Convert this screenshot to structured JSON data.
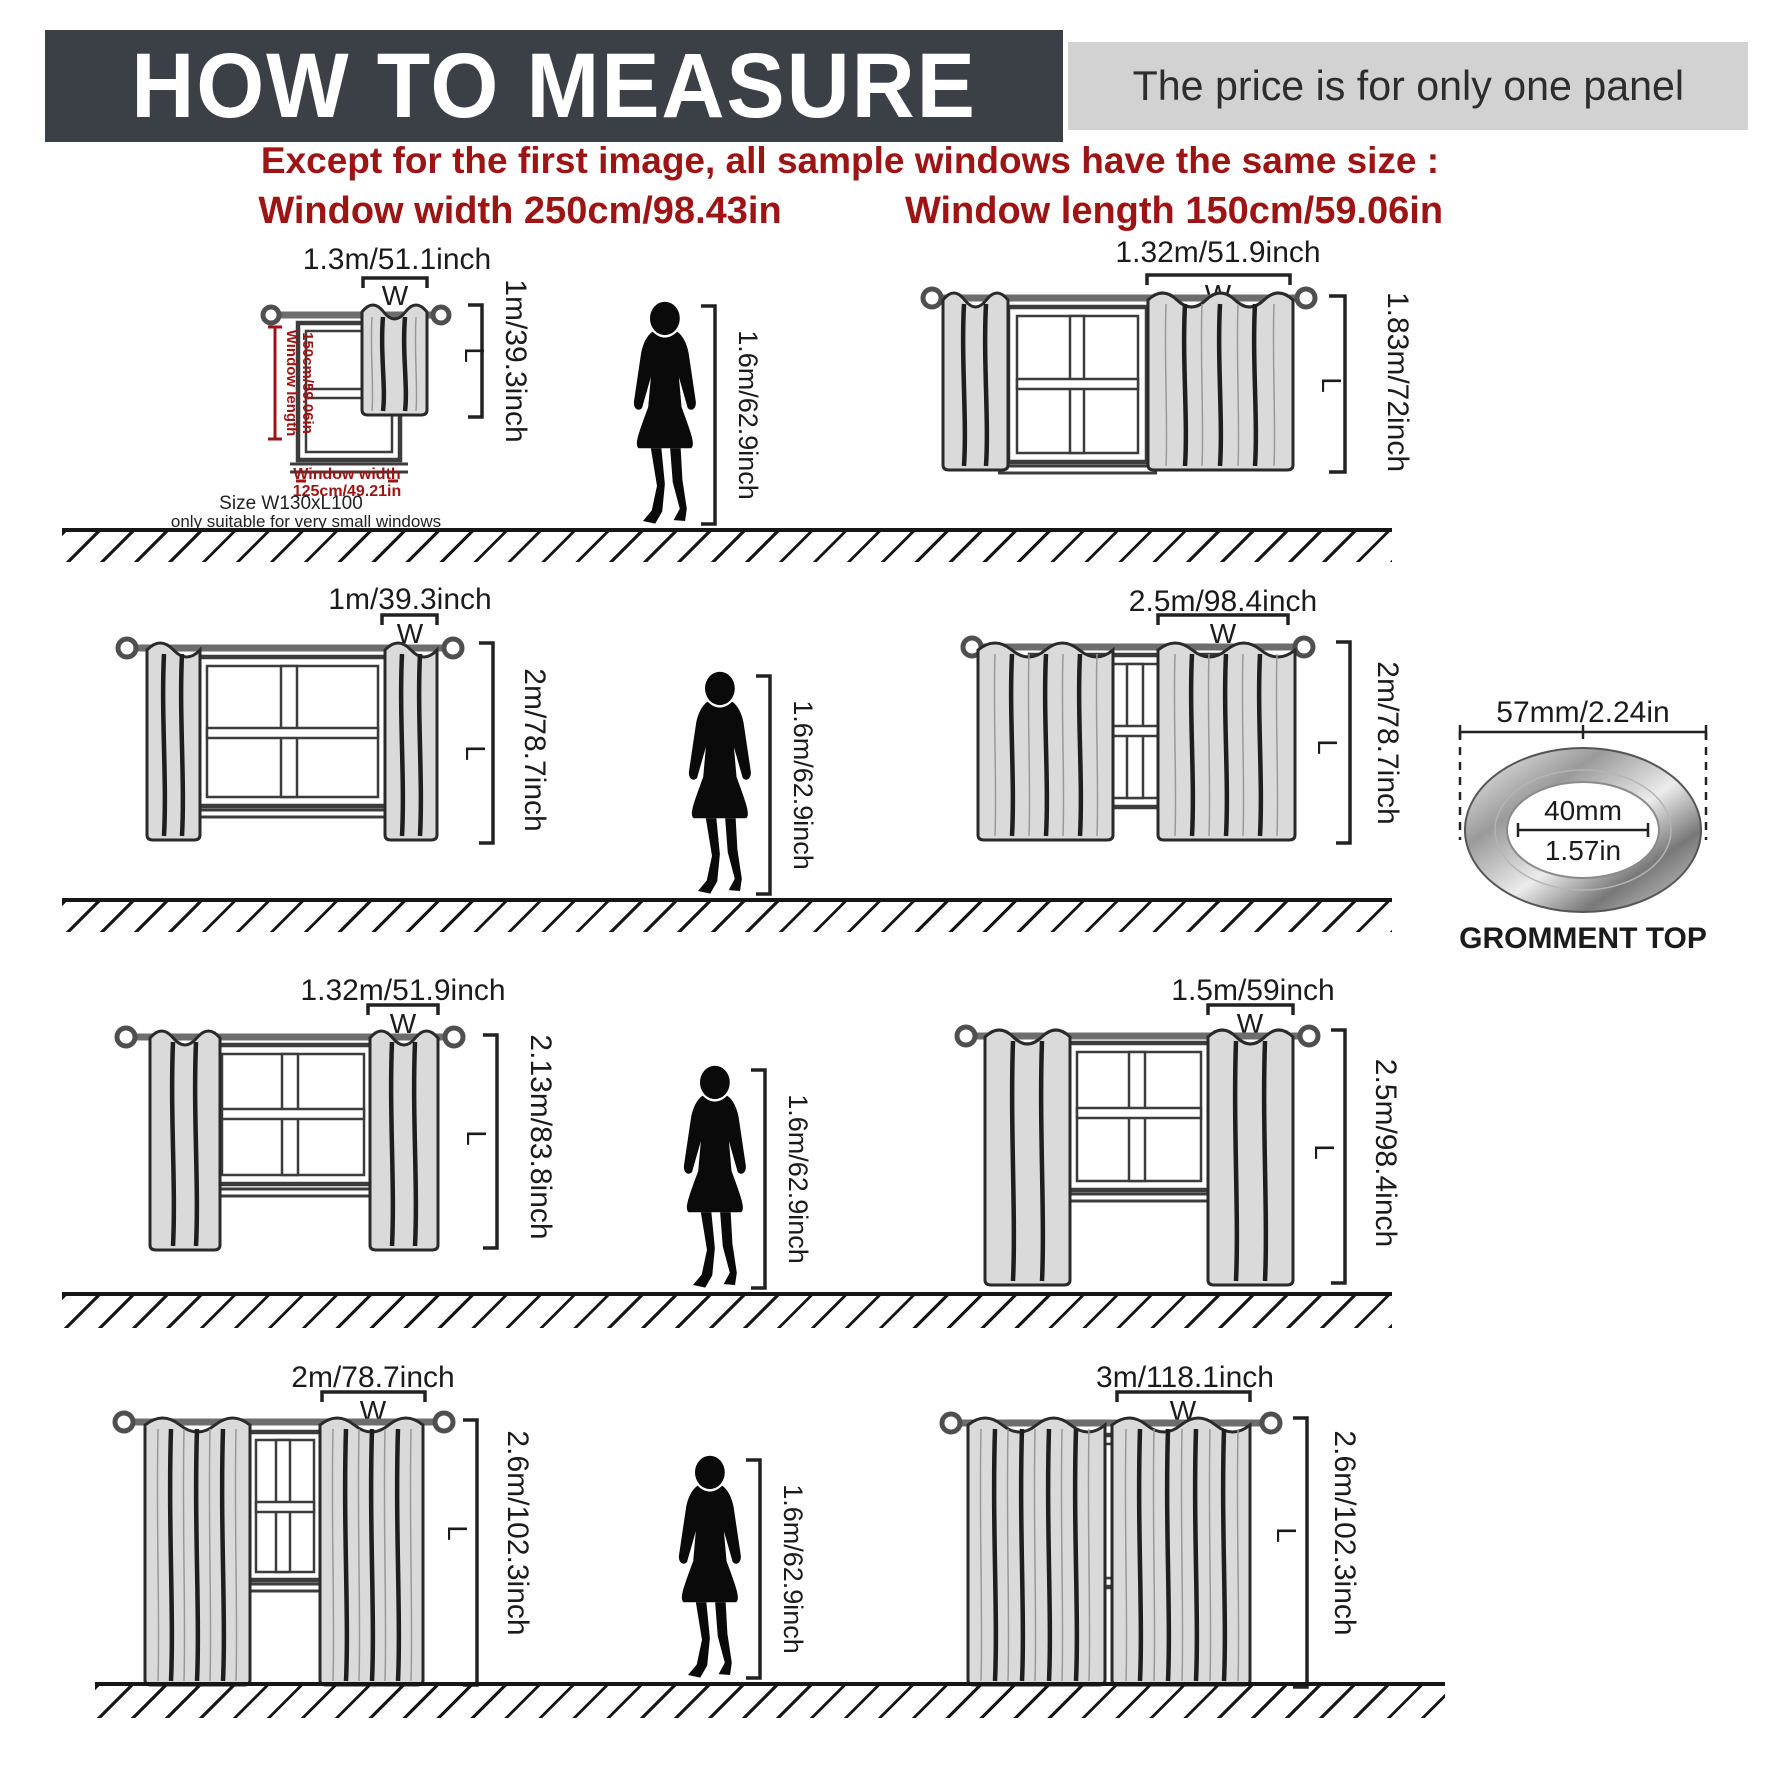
{
  "header": {
    "title": "HOW TO MEASURE",
    "price_note": "The price is for only one panel"
  },
  "intro": {
    "line1": "Except for the first image, all sample windows have the same size :",
    "width_note": "Window width 250cm/98.43in",
    "length_note": "Window length 150cm/59.06in"
  },
  "person": {
    "height_label": "1.6m/62.9inch"
  },
  "letters": {
    "w": "W",
    "l": "L"
  },
  "grommet": {
    "outer_diameter": "57mm/2.24in",
    "inner_diameter_mm": "40mm",
    "inner_diameter_in": "1.57in",
    "caption": "GROMMENT TOP"
  },
  "diagrams": {
    "d1": {
      "width_label": "1.3m/51.1inch",
      "length_label": "1m/39.3inch",
      "win_len_1": "Window length",
      "win_len_2": "150cm/59.06in",
      "win_w_1": "Window width",
      "win_w_2": "125cm/49.21in",
      "size_note": "Size W130xL100",
      "suit_note": "only suitable for very small windows"
    },
    "d2": {
      "width_label": "1.32m/51.9inch",
      "length_label": "1.83m/72inch"
    },
    "d3": {
      "width_label": "1m/39.3inch",
      "length_label": "2m/78.7inch"
    },
    "d4": {
      "width_label": "2.5m/98.4inch",
      "length_label": "2m/78.7inch"
    },
    "d5": {
      "width_label": "1.32m/51.9inch",
      "length_label": "2.13m/83.8inch"
    },
    "d6": {
      "width_label": "1.5m/59inch",
      "length_label": "2.5m/98.4inch"
    },
    "d7": {
      "width_label": "2m/78.7inch",
      "length_label": "2.6m/102.3inch"
    },
    "d8": {
      "width_label": "3m/118.1inch",
      "length_label": "2.6m/102.3inch"
    }
  },
  "colors": {
    "header_bg": "#3b4047",
    "price_bg": "#d2d2d2",
    "accent_red": "#9d1414",
    "curtain_fill": "#dadada",
    "ink": "#1b1b1b"
  }
}
